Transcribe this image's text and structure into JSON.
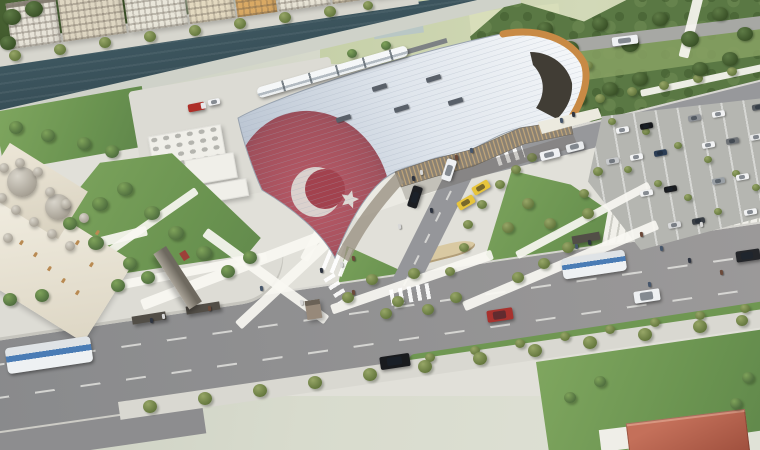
{
  "meta": {
    "type": "architectural-aerial-rendering",
    "subject": "Aerial render of a modern rail terminal with an undulating white roof printed with the Turkish flag, beside a river promenade with apartment blocks, an Ottoman-style mosque, landscaped plazas and stairs, a car park, and a tree-lined boulevard with buses and cars"
  },
  "palette": {
    "grass": "#79a45b",
    "park_green": "#54713f",
    "field_green": "#ccd5ae",
    "river": "#3c545d",
    "asphalt": "#8f8f91",
    "concrete": "#e1e0d9",
    "roof_light": "#f6f8fa",
    "roof_shade": "#b7c2d0",
    "flag_red": "#9c3f4b",
    "timber_arch": "#c88a45",
    "facade_tan": "#c2a679",
    "bus_blue": "#4a7cb5",
    "taxi_yellow": "#e7c43c",
    "dome_gray": "#b5b0a6",
    "house_roof": "#b0604a"
  },
  "scene": {
    "city_buildings": [
      [
        0,
        50,
        46,
        "#e7e3d8"
      ],
      [
        52,
        64,
        62,
        "#ded6c2"
      ],
      [
        118,
        60,
        56,
        "#e9e6da"
      ],
      [
        180,
        46,
        50,
        "#e3d9c0"
      ],
      [
        228,
        40,
        44,
        "#d9a964"
      ],
      [
        270,
        52,
        48,
        "#e8e4d6"
      ],
      [
        324,
        40,
        42,
        "#d8cdb4"
      ],
      [
        366,
        32,
        38,
        "#c9803f"
      ]
    ],
    "service_boxes": [
      [
        150,
        130,
        74,
        34
      ],
      [
        186,
        156,
        50,
        26
      ],
      [
        200,
        182,
        48,
        18
      ],
      [
        252,
        112,
        46,
        30
      ]
    ],
    "mosque": {
      "domes_large": [
        [
          22,
          182,
          15
        ],
        [
          58,
          207,
          13
        ]
      ],
      "domes_small": [
        [
          4,
          168
        ],
        [
          20,
          163
        ],
        [
          38,
          172
        ],
        [
          2,
          198
        ],
        [
          16,
          210
        ],
        [
          34,
          222
        ],
        [
          52,
          234
        ],
        [
          70,
          246
        ],
        [
          50,
          192
        ],
        [
          66,
          204
        ],
        [
          84,
          218
        ],
        [
          8,
          238
        ]
      ],
      "windows": [
        [
          20,
          240
        ],
        [
          34,
          252
        ],
        [
          48,
          266
        ],
        [
          62,
          278
        ],
        [
          76,
          290
        ],
        [
          90,
          262
        ],
        [
          76,
          240
        ],
        [
          96,
          230
        ]
      ]
    },
    "trees": [
      [
        15,
        56,
        6,
        "s"
      ],
      [
        60,
        50,
        6,
        "s"
      ],
      [
        105,
        43,
        6,
        "s"
      ],
      [
        150,
        37,
        6,
        "s"
      ],
      [
        195,
        31,
        6,
        "s"
      ],
      [
        240,
        24,
        6,
        "s"
      ],
      [
        285,
        18,
        6,
        "s"
      ],
      [
        330,
        12,
        6,
        "s"
      ],
      [
        368,
        6,
        5,
        "s"
      ],
      [
        505,
        84,
        5,
        "s"
      ],
      [
        532,
        78,
        5,
        "s"
      ],
      [
        560,
        72,
        5,
        "s"
      ],
      [
        588,
        66,
        5,
        "s"
      ],
      [
        570,
        106,
        5,
        "s"
      ],
      [
        600,
        99,
        5,
        "s"
      ],
      [
        632,
        92,
        5,
        "s"
      ],
      [
        664,
        86,
        5,
        "s"
      ],
      [
        698,
        79,
        5,
        "s"
      ],
      [
        732,
        72,
        5,
        "s"
      ],
      [
        612,
        122,
        4,
        "s"
      ],
      [
        646,
        132,
        4,
        "s"
      ],
      [
        678,
        146,
        4,
        "s"
      ],
      [
        708,
        160,
        4,
        "s"
      ],
      [
        736,
        174,
        4,
        "s"
      ],
      [
        756,
        188,
        4,
        "s"
      ],
      [
        628,
        170,
        4,
        "s"
      ],
      [
        658,
        184,
        4,
        "s"
      ],
      [
        688,
        198,
        4,
        "s"
      ],
      [
        718,
        212,
        4,
        "s"
      ],
      [
        348,
        298,
        6,
        "s"
      ],
      [
        372,
        280,
        6,
        "s"
      ],
      [
        398,
        302,
        6,
        "s"
      ],
      [
        428,
        310,
        6,
        "s"
      ],
      [
        456,
        298,
        6,
        "s"
      ],
      [
        414,
        274,
        6,
        "s"
      ],
      [
        386,
        314,
        6,
        "s"
      ],
      [
        508,
        228,
        6,
        "s"
      ],
      [
        528,
        204,
        6,
        "s"
      ],
      [
        550,
        224,
        6,
        "s"
      ],
      [
        568,
        248,
        6,
        "s"
      ],
      [
        588,
        214,
        6,
        "s"
      ],
      [
        544,
        264,
        6,
        "s"
      ],
      [
        518,
        278,
        6,
        "s"
      ],
      [
        468,
        225,
        5,
        "s"
      ],
      [
        482,
        205,
        5,
        "s"
      ],
      [
        500,
        185,
        5,
        "s"
      ],
      [
        516,
        170,
        5,
        "s"
      ],
      [
        532,
        158,
        5,
        "s"
      ],
      [
        464,
        248,
        5,
        "s"
      ],
      [
        450,
        272,
        5,
        "s"
      ],
      [
        430,
        358,
        5,
        "s"
      ],
      [
        475,
        351,
        5,
        "s"
      ],
      [
        520,
        344,
        5,
        "s"
      ],
      [
        565,
        337,
        5,
        "s"
      ],
      [
        610,
        330,
        5,
        "s"
      ],
      [
        655,
        323,
        5,
        "s"
      ],
      [
        700,
        316,
        5,
        "s"
      ],
      [
        745,
        309,
        5,
        "s"
      ],
      [
        150,
        407,
        7,
        "s"
      ],
      [
        205,
        399,
        7,
        "s"
      ],
      [
        260,
        391,
        7,
        "s"
      ],
      [
        315,
        383,
        7,
        "s"
      ],
      [
        370,
        375,
        7,
        "s"
      ],
      [
        425,
        367,
        7,
        "s"
      ],
      [
        480,
        359,
        7,
        "s"
      ],
      [
        535,
        351,
        7,
        "s"
      ],
      [
        590,
        343,
        7,
        "s"
      ],
      [
        645,
        335,
        7,
        "s"
      ],
      [
        700,
        327,
        7,
        "s"
      ],
      [
        742,
        321,
        6,
        "s"
      ],
      [
        598,
        172,
        5,
        "s"
      ],
      [
        584,
        194,
        5,
        "s"
      ],
      [
        16,
        128,
        7,
        "g"
      ],
      [
        48,
        136,
        7,
        "g"
      ],
      [
        84,
        144,
        7,
        "g"
      ],
      [
        112,
        152,
        7,
        "g"
      ],
      [
        100,
        205,
        8,
        "g"
      ],
      [
        125,
        190,
        8,
        "g"
      ],
      [
        152,
        214,
        8,
        "g"
      ],
      [
        176,
        234,
        8,
        "g"
      ],
      [
        204,
        254,
        8,
        "g"
      ],
      [
        96,
        244,
        8,
        "g"
      ],
      [
        130,
        264,
        7,
        "g"
      ],
      [
        70,
        224,
        7,
        "g"
      ],
      [
        228,
        272,
        7,
        "g"
      ],
      [
        250,
        258,
        7,
        "g"
      ],
      [
        10,
        300,
        7,
        "g"
      ],
      [
        42,
        296,
        7,
        "g"
      ],
      [
        118,
        286,
        7,
        "g"
      ],
      [
        148,
        278,
        7,
        "g"
      ],
      [
        748,
        378,
        6,
        "g"
      ],
      [
        736,
        404,
        6,
        "g"
      ],
      [
        600,
        382,
        6,
        "g"
      ],
      [
        570,
        398,
        6,
        "g"
      ],
      [
        352,
        54,
        5,
        "g"
      ],
      [
        386,
        46,
        5,
        "g"
      ],
      [
        495,
        40,
        8,
        "p"
      ],
      [
        520,
        60,
        8,
        "p"
      ],
      [
        545,
        30,
        8,
        "p"
      ],
      [
        570,
        50,
        9,
        "p"
      ],
      [
        600,
        25,
        8,
        "p"
      ],
      [
        630,
        45,
        9,
        "p"
      ],
      [
        660,
        20,
        8,
        "p"
      ],
      [
        690,
        40,
        9,
        "p"
      ],
      [
        720,
        15,
        8,
        "p"
      ],
      [
        745,
        35,
        8,
        "p"
      ],
      [
        700,
        70,
        8,
        "p"
      ],
      [
        730,
        60,
        8,
        "p"
      ],
      [
        640,
        80,
        8,
        "p"
      ],
      [
        610,
        90,
        8,
        "p"
      ],
      [
        580,
        100,
        7,
        "p"
      ],
      [
        560,
        70,
        7,
        "p"
      ],
      [
        535,
        85,
        7,
        "p"
      ],
      [
        12,
        18,
        9,
        "p"
      ],
      [
        34,
        10,
        9,
        "p"
      ],
      [
        8,
        44,
        8,
        "p"
      ]
    ],
    "walkways": [
      [
        0,
        262,
        150,
        10,
        -14
      ],
      [
        40,
        296,
        230,
        9,
        -11
      ],
      [
        140,
        300,
        210,
        11,
        -21
      ],
      [
        235,
        322,
        135,
        10,
        -43
      ],
      [
        300,
        258,
        120,
        9,
        -62
      ],
      [
        330,
        305,
        170,
        10,
        -19
      ],
      [
        462,
        302,
        210,
        10,
        -23
      ],
      [
        515,
        252,
        150,
        8,
        -28
      ],
      [
        640,
        90,
        130,
        7,
        -12
      ],
      [
        208,
        228,
        150,
        10,
        36
      ],
      [
        96,
        256,
        120,
        8,
        -35
      ],
      [
        694,
        -6,
        10,
        64,
        14
      ]
    ],
    "crosswalks": [
      [
        326,
        244,
        22,
        30,
        22
      ],
      [
        390,
        286,
        44,
        16,
        -10
      ],
      [
        496,
        148,
        28,
        14,
        -18
      ],
      [
        322,
        282,
        28,
        12,
        58
      ]
    ],
    "skylights": [
      [
        372,
        85
      ],
      [
        426,
        76
      ],
      [
        394,
        106
      ],
      [
        448,
        99
      ],
      [
        336,
        116
      ]
    ],
    "vehicles": [
      [
        6,
        342,
        86,
        26,
        -8.5,
        "bus",
        ""
      ],
      [
        562,
        254,
        64,
        21,
        -8.5,
        "bus",
        ""
      ],
      [
        612,
        36,
        26,
        9,
        -7,
        "van",
        "#eff1f3"
      ],
      [
        634,
        290,
        26,
        12,
        -8.5,
        "car",
        "#eef0f2"
      ],
      [
        487,
        309,
        26,
        12,
        -8.5,
        "car",
        "#a8322e"
      ],
      [
        380,
        355,
        30,
        13,
        -8.5,
        "car",
        "#191b1e"
      ],
      [
        736,
        250,
        24,
        11,
        -8.5,
        "car",
        "#24262a"
      ],
      [
        404,
        192,
        22,
        10,
        -72,
        "car",
        "#1c1e22"
      ],
      [
        438,
        165,
        22,
        10,
        -72,
        "car",
        "#eef0f2"
      ],
      [
        472,
        183,
        18,
        9,
        -30,
        "taxi",
        "#e7c43c"
      ],
      [
        457,
        198,
        18,
        9,
        -30,
        "taxi",
        "#e7c43c"
      ],
      [
        540,
        150,
        20,
        9,
        -14,
        "van",
        "#f0f1f3"
      ],
      [
        566,
        143,
        18,
        8,
        -14,
        "van",
        "#e8eaec"
      ],
      [
        188,
        103,
        17,
        8,
        -11,
        "truck",
        "#ae2f28"
      ],
      [
        208,
        99,
        12,
        6,
        -11,
        "van",
        "#f2f3f5"
      ]
    ],
    "parked_cars": [
      [
        616,
        127,
        "#f2f3f4"
      ],
      [
        640,
        123,
        "#16181b"
      ],
      [
        688,
        115,
        "#8e9297"
      ],
      [
        712,
        111,
        "#f2f3f4"
      ],
      [
        752,
        104,
        "#555a60"
      ],
      [
        606,
        158,
        "#c8cacc"
      ],
      [
        630,
        154,
        "#f2f3f4"
      ],
      [
        654,
        150,
        "#2b3d55"
      ],
      [
        702,
        142,
        "#f2f3f4"
      ],
      [
        726,
        138,
        "#6e7276"
      ],
      [
        750,
        134,
        "#e8e9ea"
      ],
      [
        640,
        190,
        "#f2f3f4"
      ],
      [
        664,
        186,
        "#1a1c1f"
      ],
      [
        712,
        178,
        "#9aa0a5"
      ],
      [
        736,
        174,
        "#f2f3f4"
      ],
      [
        668,
        222,
        "#d8d9da"
      ],
      [
        692,
        218,
        "#3a3f45"
      ],
      [
        744,
        209,
        "#f2f3f4"
      ]
    ],
    "train": {
      "x": 256,
      "y": 88,
      "w": 156,
      "h": 11,
      "rot": -16
    },
    "people": [
      [
        412,
        176
      ],
      [
        420,
        170
      ],
      [
        455,
        155
      ],
      [
        470,
        148
      ],
      [
        430,
        208
      ],
      [
        398,
        224
      ],
      [
        640,
        232
      ],
      [
        660,
        246
      ],
      [
        688,
        258
      ],
      [
        700,
        222
      ],
      [
        720,
        270
      ],
      [
        648,
        282
      ],
      [
        320,
        268
      ],
      [
        300,
        300
      ],
      [
        352,
        290
      ],
      [
        260,
        286
      ],
      [
        150,
        318
      ],
      [
        162,
        314
      ],
      [
        208,
        306
      ],
      [
        575,
        244
      ],
      [
        588,
        240
      ],
      [
        340,
        262
      ],
      [
        352,
        256
      ],
      [
        560,
        118
      ],
      [
        572,
        112
      ]
    ],
    "person_colors": [
      "#2e3440",
      "#d8d8d8",
      "#6b4a3a",
      "#46566b"
    ]
  }
}
